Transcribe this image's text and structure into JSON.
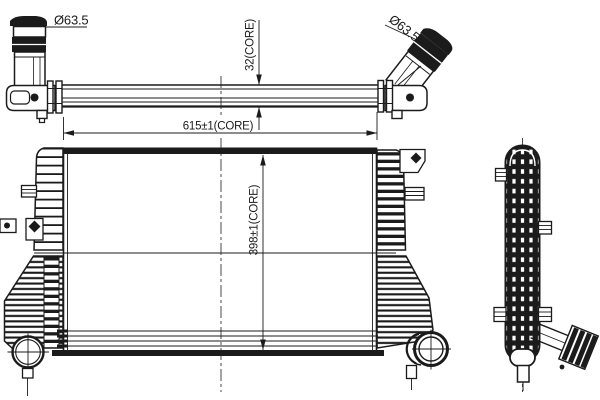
{
  "colors": {
    "background": "#ffffff",
    "ink": "#1b1b1b"
  },
  "dimensions": {
    "left_pipe_diameter": "Ø63.5",
    "right_pipe_diameter": "Ø63.5",
    "core_depth": "32(CORE)",
    "core_width": "615±1(CORE)",
    "core_height": "398±1(CORE)"
  }
}
